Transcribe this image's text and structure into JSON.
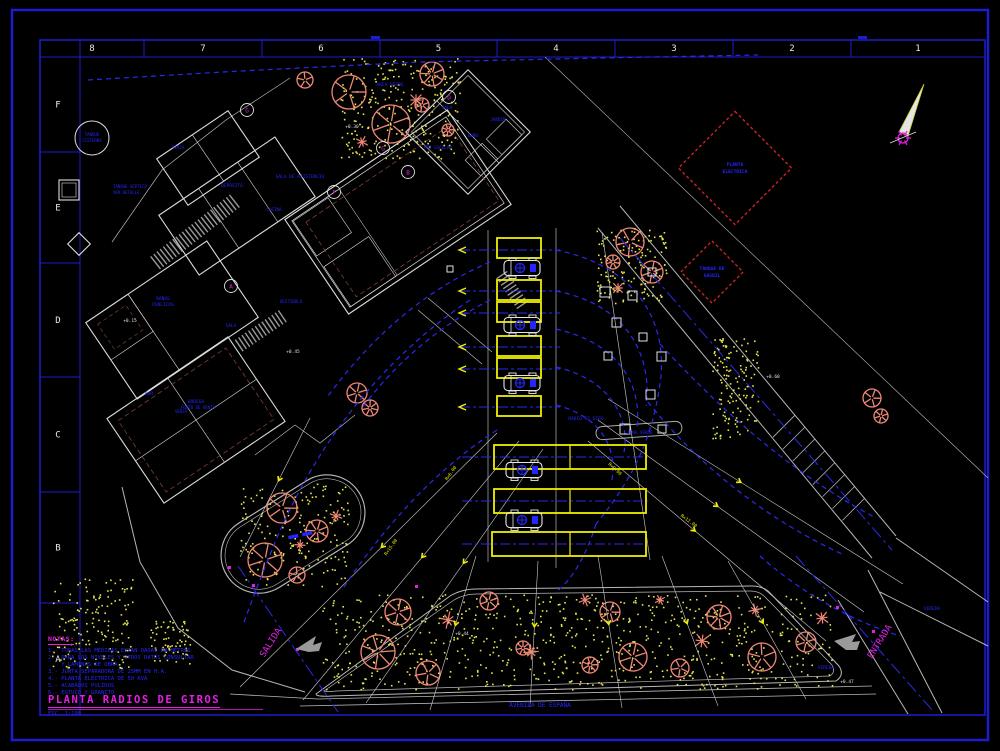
{
  "colors": {
    "frame_blue": "#1d1dd0",
    "text_blue": "#2525ff",
    "magenta": "#e520e5",
    "yellow": "#f0f000",
    "speckle": "#e6e652",
    "salmon": "#f08878",
    "red": "#cc2222",
    "white": "#e0e0e0",
    "gray": "#9a9a9a",
    "brown": "#7d4030"
  },
  "frame": {
    "columns": [
      "8",
      "7",
      "6",
      "5",
      "4",
      "3",
      "2",
      "1"
    ],
    "rows": [
      "F",
      "E",
      "D",
      "C",
      "B",
      "A"
    ]
  },
  "title_block": {
    "title": "PLANTA RADIOS DE GIROS",
    "scale": "ESC. 1:100"
  },
  "notes": {
    "header": "NOTAS:",
    "lines": [
      "1.- TODAS LAS MEDIDAS ESTAN DADAS EN METROS",
      "2.- PARA LOS NIVELES Y OTROS DATOS CONSULTAR",
      "    Y LAMINAS DE OBRA",
      "3.- JUNTA SEPARADORA DE 25MM EN H.A.",
      "4.- PLANTA ELECTRICA DE 50 KVA",
      "5.- ACABADOS PULIDOS",
      "6.- ESTUCO Y GRANITO"
    ]
  },
  "drawing": {
    "diamonds": [
      {
        "cx": 735,
        "cy": 168,
        "half": 40,
        "lines": [
          "PLANTA",
          "ELECTRICA"
        ]
      },
      {
        "cx": 712,
        "cy": 272,
        "half": 22,
        "lines": [
          "TANQUE DE",
          "GASOIL"
        ]
      }
    ],
    "labels": [
      {
        "t": "SALIDA",
        "x": 273,
        "y": 644,
        "c": "magenta",
        "s": 9,
        "r": -58
      },
      {
        "t": "ENTRADA",
        "x": 882,
        "y": 643,
        "c": "magenta",
        "s": 9,
        "r": -58
      },
      {
        "t": "AVENIDA DE ESPAÑA",
        "x": 540,
        "y": 707,
        "c": "blue",
        "s": 6,
        "r": 0
      },
      {
        "t": "VEREDA",
        "x": 932,
        "y": 610,
        "c": "blue",
        "s": 4.5,
        "r": 0
      },
      {
        "t": "VEREDA",
        "x": 826,
        "y": 669,
        "c": "blue",
        "s": 4.5,
        "r": 0
      },
      {
        "t": "RADIO DE GIRO",
        "x": 586,
        "y": 420,
        "c": "blue",
        "s": 4.5,
        "r": 0
      },
      {
        "t": "ZONA VERDE",
        "x": 640,
        "y": 434,
        "c": "blue",
        "s": 4.2,
        "r": 0
      },
      {
        "t": "AREA VERDE",
        "x": 390,
        "y": 86,
        "c": "blue",
        "s": 4.5,
        "r": 0
      },
      {
        "t": "TANQUE",
        "x": 92,
        "y": 136,
        "c": "blue",
        "s": 4,
        "r": 0
      },
      {
        "t": "CISTERNA",
        "x": 92,
        "y": 142,
        "c": "blue",
        "s": 4,
        "r": 0
      },
      {
        "t": "TANQUE SEPTICO",
        "x": 113,
        "y": 188,
        "c": "blue",
        "s": 4,
        "r": 0,
        "a": "start"
      },
      {
        "t": "VER DETALLE",
        "x": 113,
        "y": 194,
        "c": "blue",
        "s": 4,
        "r": 0,
        "a": "start"
      },
      {
        "t": "BAÑOS",
        "x": 163,
        "y": 300,
        "c": "blue",
        "s": 4.5,
        "r": 0
      },
      {
        "t": "PUBLICOS",
        "x": 163,
        "y": 306,
        "c": "blue",
        "s": 4.5,
        "r": 0
      },
      {
        "t": "SALA",
        "x": 231,
        "y": 327,
        "c": "blue",
        "s": 4.5,
        "r": 0
      },
      {
        "t": "DEPOSITO",
        "x": 232,
        "y": 187,
        "c": "blue",
        "s": 4.5,
        "r": 0
      },
      {
        "t": "SALA DE ASISTENCIA",
        "x": 300,
        "y": 178,
        "c": "blue",
        "s": 4.5,
        "r": 0
      },
      {
        "t": "COCINA",
        "x": 274,
        "y": 211,
        "c": "blue",
        "s": 4.2,
        "r": 0
      },
      {
        "t": "BAR",
        "x": 149,
        "y": 395,
        "c": "blue",
        "s": 4.5,
        "r": 0
      },
      {
        "t": "BODEGA",
        "x": 196,
        "y": 403,
        "c": "blue",
        "s": 4.5,
        "r": 0
      },
      {
        "t": "PUNTO DE VENTA",
        "x": 198,
        "y": 409,
        "c": "blue",
        "s": 4,
        "r": 0
      },
      {
        "t": "VESTIBULO",
        "x": 291,
        "y": 303,
        "c": "blue",
        "s": 4.2,
        "r": 0
      },
      {
        "t": "SALA",
        "x": 447,
        "y": 109,
        "c": "blue",
        "s": 4.5,
        "r": 0
      },
      {
        "t": "JARDIN",
        "x": 498,
        "y": 121,
        "c": "blue",
        "s": 4.2,
        "r": 0
      },
      {
        "t": "BAÑO",
        "x": 473,
        "y": 137,
        "c": "blue",
        "s": 4.2,
        "r": 0
      },
      {
        "t": "PRE ESCOLAR",
        "x": 438,
        "y": 149,
        "c": "blue",
        "s": 4.2,
        "r": 0
      },
      {
        "t": "VERJA",
        "x": 178,
        "y": 149,
        "c": "blue",
        "s": 4,
        "r": 0
      },
      {
        "t": "VERJA",
        "x": 181,
        "y": 413,
        "c": "blue",
        "s": 4,
        "r": 0
      },
      {
        "t": "+0.15",
        "x": 130,
        "y": 322,
        "c": "white",
        "s": 4.5,
        "r": 0
      },
      {
        "t": "+0.30",
        "x": 352,
        "y": 128,
        "c": "white",
        "s": 4.5,
        "r": 0
      },
      {
        "t": "+0.45",
        "x": 293,
        "y": 353,
        "c": "white",
        "s": 4.5,
        "r": 0
      },
      {
        "t": "+0.60",
        "x": 773,
        "y": 378,
        "c": "white",
        "s": 4.5,
        "r": 0
      },
      {
        "t": "+0.44",
        "x": 462,
        "y": 635,
        "c": "white",
        "s": 4.5,
        "r": 0
      },
      {
        "t": "+0.47",
        "x": 847,
        "y": 683,
        "c": "white",
        "s": 4.5,
        "r": 0
      },
      {
        "t": "R=6.00",
        "x": 452,
        "y": 474,
        "c": "yellow",
        "s": 4.5,
        "r": -55
      },
      {
        "t": "R=9.00",
        "x": 614,
        "y": 470,
        "c": "yellow",
        "s": 4.5,
        "r": 42
      },
      {
        "t": "R=12.00",
        "x": 688,
        "y": 522,
        "c": "yellow",
        "s": 4.5,
        "r": 36
      },
      {
        "t": "R=15.00",
        "x": 392,
        "y": 548,
        "c": "yellow",
        "s": 4.5,
        "r": -55
      }
    ],
    "bubbles": [
      {
        "x": 247,
        "y": 110,
        "l": "G"
      },
      {
        "x": 334,
        "y": 192,
        "l": "F"
      },
      {
        "x": 231,
        "y": 286,
        "l": "A"
      },
      {
        "x": 383,
        "y": 148,
        "l": "G"
      },
      {
        "x": 449,
        "y": 97,
        "l": "D"
      },
      {
        "x": 408,
        "y": 172,
        "l": "B"
      }
    ],
    "trees": [
      [
        349,
        92,
        17
      ],
      [
        391,
        124,
        19
      ],
      [
        432,
        74,
        12
      ],
      [
        305,
        80,
        8
      ],
      [
        422,
        105,
        7
      ],
      [
        448,
        130,
        6
      ],
      [
        630,
        242,
        14
      ],
      [
        652,
        272,
        11
      ],
      [
        613,
        262,
        7
      ],
      [
        282,
        508,
        15
      ],
      [
        265,
        560,
        17
      ],
      [
        317,
        531,
        11
      ],
      [
        297,
        575,
        8
      ],
      [
        398,
        612,
        13
      ],
      [
        378,
        652,
        17
      ],
      [
        428,
        673,
        12
      ],
      [
        489,
        601,
        9
      ],
      [
        523,
        648,
        7
      ],
      [
        610,
        612,
        10
      ],
      [
        633,
        657,
        14
      ],
      [
        719,
        617,
        12
      ],
      [
        762,
        657,
        14
      ],
      [
        806,
        642,
        10
      ],
      [
        590,
        665,
        8
      ],
      [
        680,
        668,
        9
      ],
      [
        357,
        393,
        10
      ],
      [
        370,
        408,
        8
      ],
      [
        872,
        398,
        9
      ],
      [
        881,
        416,
        7
      ]
    ],
    "palms": [
      [
        416,
        100,
        7
      ],
      [
        362,
        142,
        6
      ],
      [
        448,
        620,
        8
      ],
      [
        531,
        652,
        7
      ],
      [
        585,
        600,
        6
      ],
      [
        702,
        641,
        8
      ],
      [
        822,
        618,
        7
      ],
      [
        336,
        516,
        6
      ],
      [
        300,
        545,
        5
      ],
      [
        755,
        610,
        6
      ],
      [
        660,
        600,
        5
      ],
      [
        618,
        288,
        6
      ]
    ],
    "speckles": [
      [
        340,
        58,
        120,
        100,
        260
      ],
      [
        596,
        228,
        70,
        75,
        150
      ],
      [
        712,
        338,
        46,
        100,
        140
      ],
      [
        240,
        482,
        110,
        105,
        180
      ],
      [
        322,
        594,
        510,
        95,
        700
      ],
      [
        52,
        578,
        80,
        90,
        160
      ],
      [
        150,
        618,
        40,
        45,
        70
      ]
    ],
    "stalls": [
      [
        497,
        238,
        44,
        20
      ],
      [
        497,
        280,
        44,
        20
      ],
      [
        497,
        302,
        44,
        20
      ],
      [
        497,
        336,
        44,
        20
      ],
      [
        497,
        358,
        44,
        20
      ],
      [
        497,
        396,
        44,
        20
      ],
      [
        494,
        445,
        152,
        24
      ],
      [
        494,
        489,
        152,
        24
      ],
      [
        492,
        532,
        154,
        24
      ]
    ],
    "stall_dividers": [
      [
        570,
        445,
        570,
        469
      ],
      [
        570,
        489,
        570,
        513
      ],
      [
        570,
        532,
        570,
        556
      ]
    ],
    "cars": [
      [
        522,
        268
      ],
      [
        522,
        325
      ],
      [
        522,
        383
      ],
      [
        524,
        470
      ],
      [
        524,
        520
      ]
    ],
    "squares": [
      [
        600,
        287,
        10
      ],
      [
        628,
        291,
        9
      ],
      [
        648,
        268,
        8
      ],
      [
        612,
        318,
        9
      ],
      [
        639,
        333,
        8
      ],
      [
        604,
        352,
        8
      ],
      [
        657,
        352,
        9
      ],
      [
        646,
        390,
        9
      ],
      [
        620,
        424,
        10
      ],
      [
        658,
        425,
        8
      ],
      [
        447,
        266,
        6
      ]
    ],
    "fan_lines": [
      [
        497,
        433,
        240,
        687
      ],
      [
        519,
        441,
        303,
        700
      ],
      [
        543,
        449,
        366,
        703
      ],
      [
        476,
        556,
        430,
        710
      ],
      [
        538,
        561,
        530,
        707
      ],
      [
        598,
        556,
        622,
        708
      ],
      [
        662,
        556,
        718,
        706
      ],
      [
        728,
        561,
        806,
        699
      ],
      [
        608,
        399,
        903,
        584
      ],
      [
        598,
        420,
        864,
        612
      ],
      [
        588,
        441,
        826,
        641
      ],
      [
        310,
        418,
        240,
        557
      ]
    ],
    "arcs": [
      "M556,250 C646,268 668,332 660,384 C652,440 632,480 596,524",
      "M556,291 C632,306 652,360 646,406",
      "M556,329 C622,344 642,388 637,428",
      "M556,367 C612,380 630,420 624,452",
      "M556,405 C602,417 617,448 612,480",
      "M596,524 C586,556 572,580 556,592",
      "M648,402 C702,470 772,522 842,554",
      "M660,344 C730,420 800,478 876,518",
      "M490,262 C420,292 368,342 328,396",
      "M490,300 C432,330 392,368 362,408",
      "M497,430 C432,472 380,532 342,590",
      "M470,300 C380,360 310,450 268,560 C258,584 250,606 244,622",
      "M760,556 C800,592 850,620 900,636",
      "M88,80 L240,71 L420,62 L600,58 L758,55"
    ],
    "centerlines": [
      "M238,566 L338,712",
      "M796,556 L934,712",
      "M620,238 L892,550"
    ],
    "stall_center_ys": [
      250,
      291,
      313,
      347,
      369,
      407
    ],
    "wide_center_ys": [
      457,
      501,
      544
    ],
    "blue_dashes": [
      [
        288,
        536
      ],
      [
        302,
        533
      ]
    ],
    "magenta_dots": [
      [
        252,
        584
      ],
      [
        296,
        648
      ],
      [
        836,
        606
      ],
      [
        872,
        630
      ],
      [
        415,
        585
      ],
      [
        228,
        566
      ]
    ],
    "north_arrow": {
      "blade": "924,84 899,132 908,136",
      "ox": 903,
      "oy": 138
    }
  }
}
